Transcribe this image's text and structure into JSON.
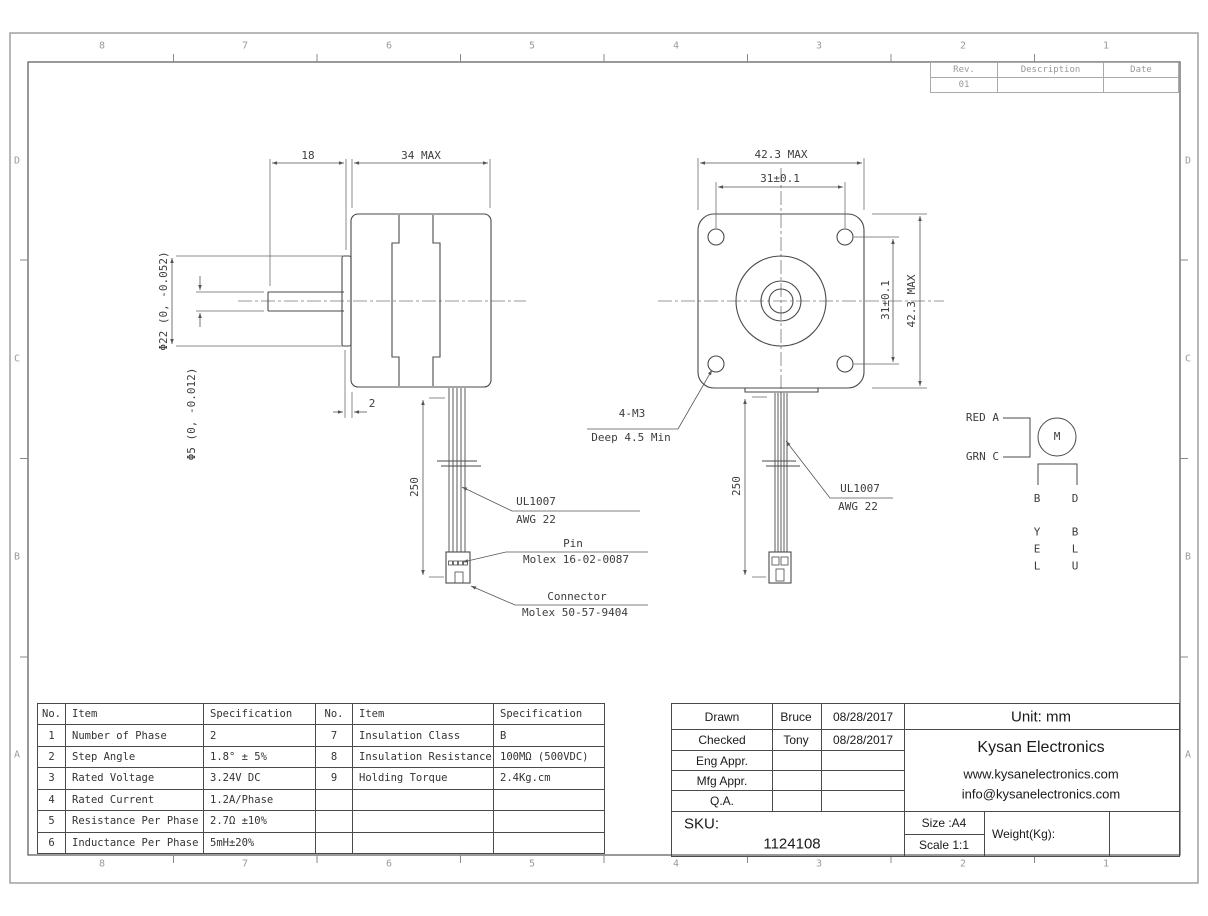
{
  "drawing": {
    "zones": {
      "top": [
        "8",
        "7",
        "6",
        "5",
        "4",
        "3",
        "2",
        "1"
      ],
      "bottom": [
        "8",
        "7",
        "6",
        "5",
        "4",
        "3",
        "2",
        "1"
      ],
      "left": [
        "D",
        "C",
        "B",
        "A"
      ],
      "right": [
        "D",
        "C",
        "B",
        "A"
      ]
    }
  },
  "rev_table": {
    "col_rev": "Rev.",
    "col_desc": "Description",
    "col_date": "Date",
    "rev_value": "01"
  },
  "side_view": {
    "dim_shaft_length": "18",
    "dim_body_length": "34 MAX",
    "dim_boss_dia": "Φ22 (0, -0.052)",
    "dim_shaft_dia": "Φ5 (0, -0.012)",
    "dim_boss_thickness": "2",
    "dim_cable_length": "250",
    "wire_label_1": "UL1007",
    "wire_label_2": "AWG 22",
    "pin_label_1": "Pin",
    "pin_label_2": "Molex 16-02-0087",
    "connector_label_1": "Connector",
    "connector_label_2": "Molex 50-57-9404"
  },
  "front_view": {
    "dim_width": "42.3 MAX",
    "dim_hole_spacing_h": "31±0.1",
    "dim_hole_spacing_v": "31±0.1",
    "dim_height": "42.3 MAX",
    "dim_cable_length": "250",
    "tap_label_1": "4-M3",
    "tap_label_2": "Deep 4.5 Min",
    "wire_label_1": "UL1007",
    "wire_label_2": "AWG 22"
  },
  "wiring_diagram": {
    "lead_a": "RED A",
    "lead_c": "GRN C",
    "motor": "M",
    "terminal_b": "B",
    "terminal_d": "D",
    "wire_b_color": "Y\nE\nL",
    "wire_d_color": "B\nL\nU"
  },
  "spec_table_1": {
    "headers": {
      "no": "No.",
      "item": "Item",
      "spec": "Specification"
    },
    "rows": [
      {
        "no": "1",
        "item": "Number of Phase",
        "spec": "2"
      },
      {
        "no": "2",
        "item": "Step Angle",
        "spec": "1.8° ± 5%"
      },
      {
        "no": "3",
        "item": "Rated Voltage",
        "spec": "3.24V DC"
      },
      {
        "no": "4",
        "item": "Rated Current",
        "spec": "1.2A/Phase"
      },
      {
        "no": "5",
        "item": "Resistance Per Phase",
        "spec": "2.7Ω ±10%"
      },
      {
        "no": "6",
        "item": "Inductance Per Phase",
        "spec": "5mH±20%"
      }
    ]
  },
  "spec_table_2": {
    "headers": {
      "no": "No.",
      "item": "Item",
      "spec": "Specification"
    },
    "rows": [
      {
        "no": "7",
        "item": "Insulation Class",
        "spec": "B"
      },
      {
        "no": "8",
        "item": "Insulation Resistance",
        "spec": "100MΩ (500VDC)"
      },
      {
        "no": "9",
        "item": "Holding Torque",
        "spec": "2.4Kg.cm"
      },
      {
        "no": "",
        "item": "",
        "spec": ""
      },
      {
        "no": "",
        "item": "",
        "spec": ""
      },
      {
        "no": "",
        "item": "",
        "spec": ""
      }
    ]
  },
  "title_block": {
    "drawn_label": "Drawn",
    "drawn_name": "Bruce",
    "drawn_date": "08/28/2017",
    "checked_label": "Checked",
    "checked_name": "Tony",
    "checked_date": "08/28/2017",
    "eng_label": "Eng Appr.",
    "mfg_label": "Mfg Appr.",
    "qa_label": "Q.A.",
    "sku_label": "SKU:",
    "sku_value": "1124108",
    "unit": "Unit: mm",
    "company": "Kysan Electronics",
    "website": "www.kysanelectronics.com",
    "email": "info@kysanelectronics.com",
    "size": "Size :A4",
    "scale": "Scale 1:1",
    "weight": "Weight(Kg):"
  }
}
